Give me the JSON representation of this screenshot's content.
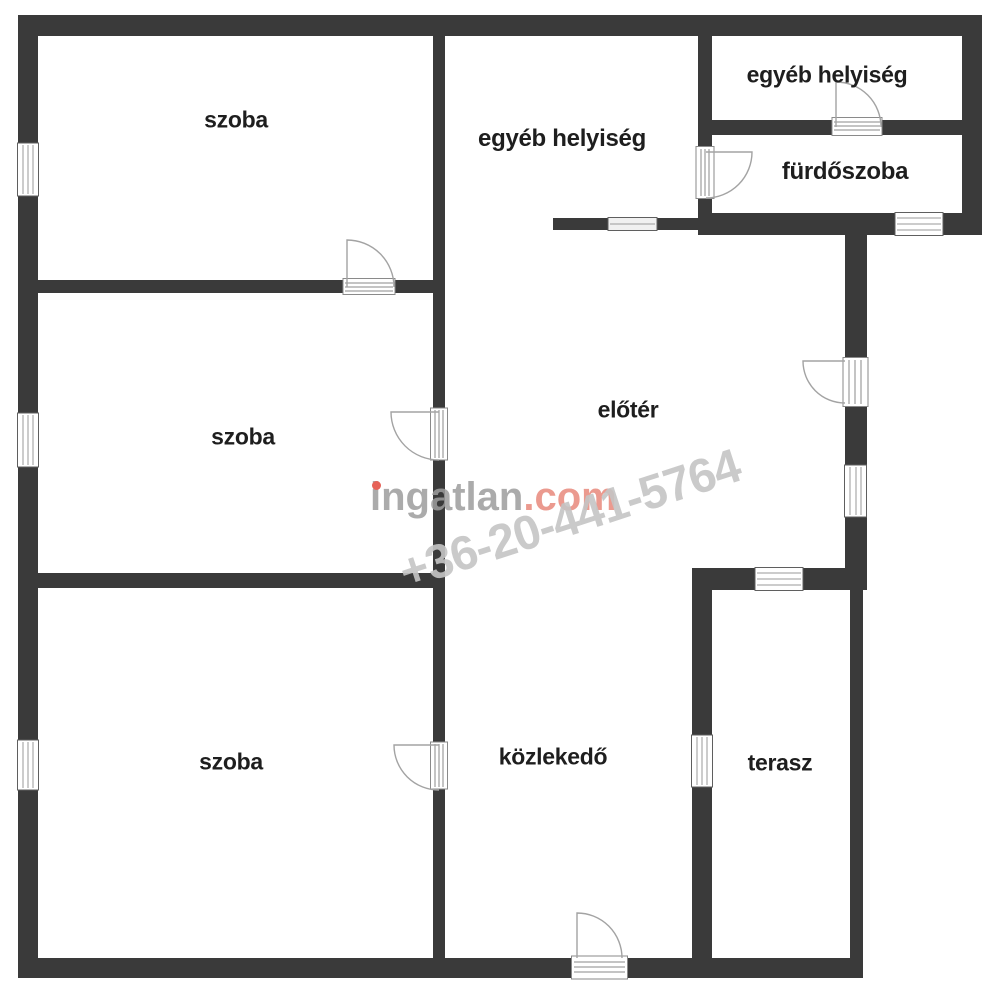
{
  "page": {
    "width": 1000,
    "height": 997,
    "background": "#ffffff"
  },
  "floorplan": {
    "rooms": [
      {
        "id": "szoba-top",
        "label": "szoba"
      },
      {
        "id": "egyeb-helyiseg-top",
        "label": "egyéb helyiség"
      },
      {
        "id": "egyeb-helyiseg-right",
        "label": "egyéb helyiség"
      },
      {
        "id": "furdoszoba",
        "label": "fürdőszoba"
      },
      {
        "id": "eloter",
        "label": "előtér"
      },
      {
        "id": "szoba-middle",
        "label": "szoba"
      },
      {
        "id": "szoba-bottom",
        "label": "szoba"
      },
      {
        "id": "kozlekedo",
        "label": "közlekedő"
      },
      {
        "id": "terasz",
        "label": "terasz"
      }
    ],
    "colors": {
      "wall": "#3a3a3a",
      "label": "#1e1e1e",
      "frame": "#5f5f5f",
      "inner_line": "#9a9a9a",
      "door_arc": "#a3a3a3"
    }
  },
  "watermark": {
    "brand_gray": "ingatlan",
    "brand_red": ".com",
    "phone": "+36-20-441-5764",
    "brand_gray_color": "#9d9d9d",
    "brand_red_color": "#e8897c",
    "dot_color": "#e2473b",
    "phone_color": "#c5c5c5"
  }
}
